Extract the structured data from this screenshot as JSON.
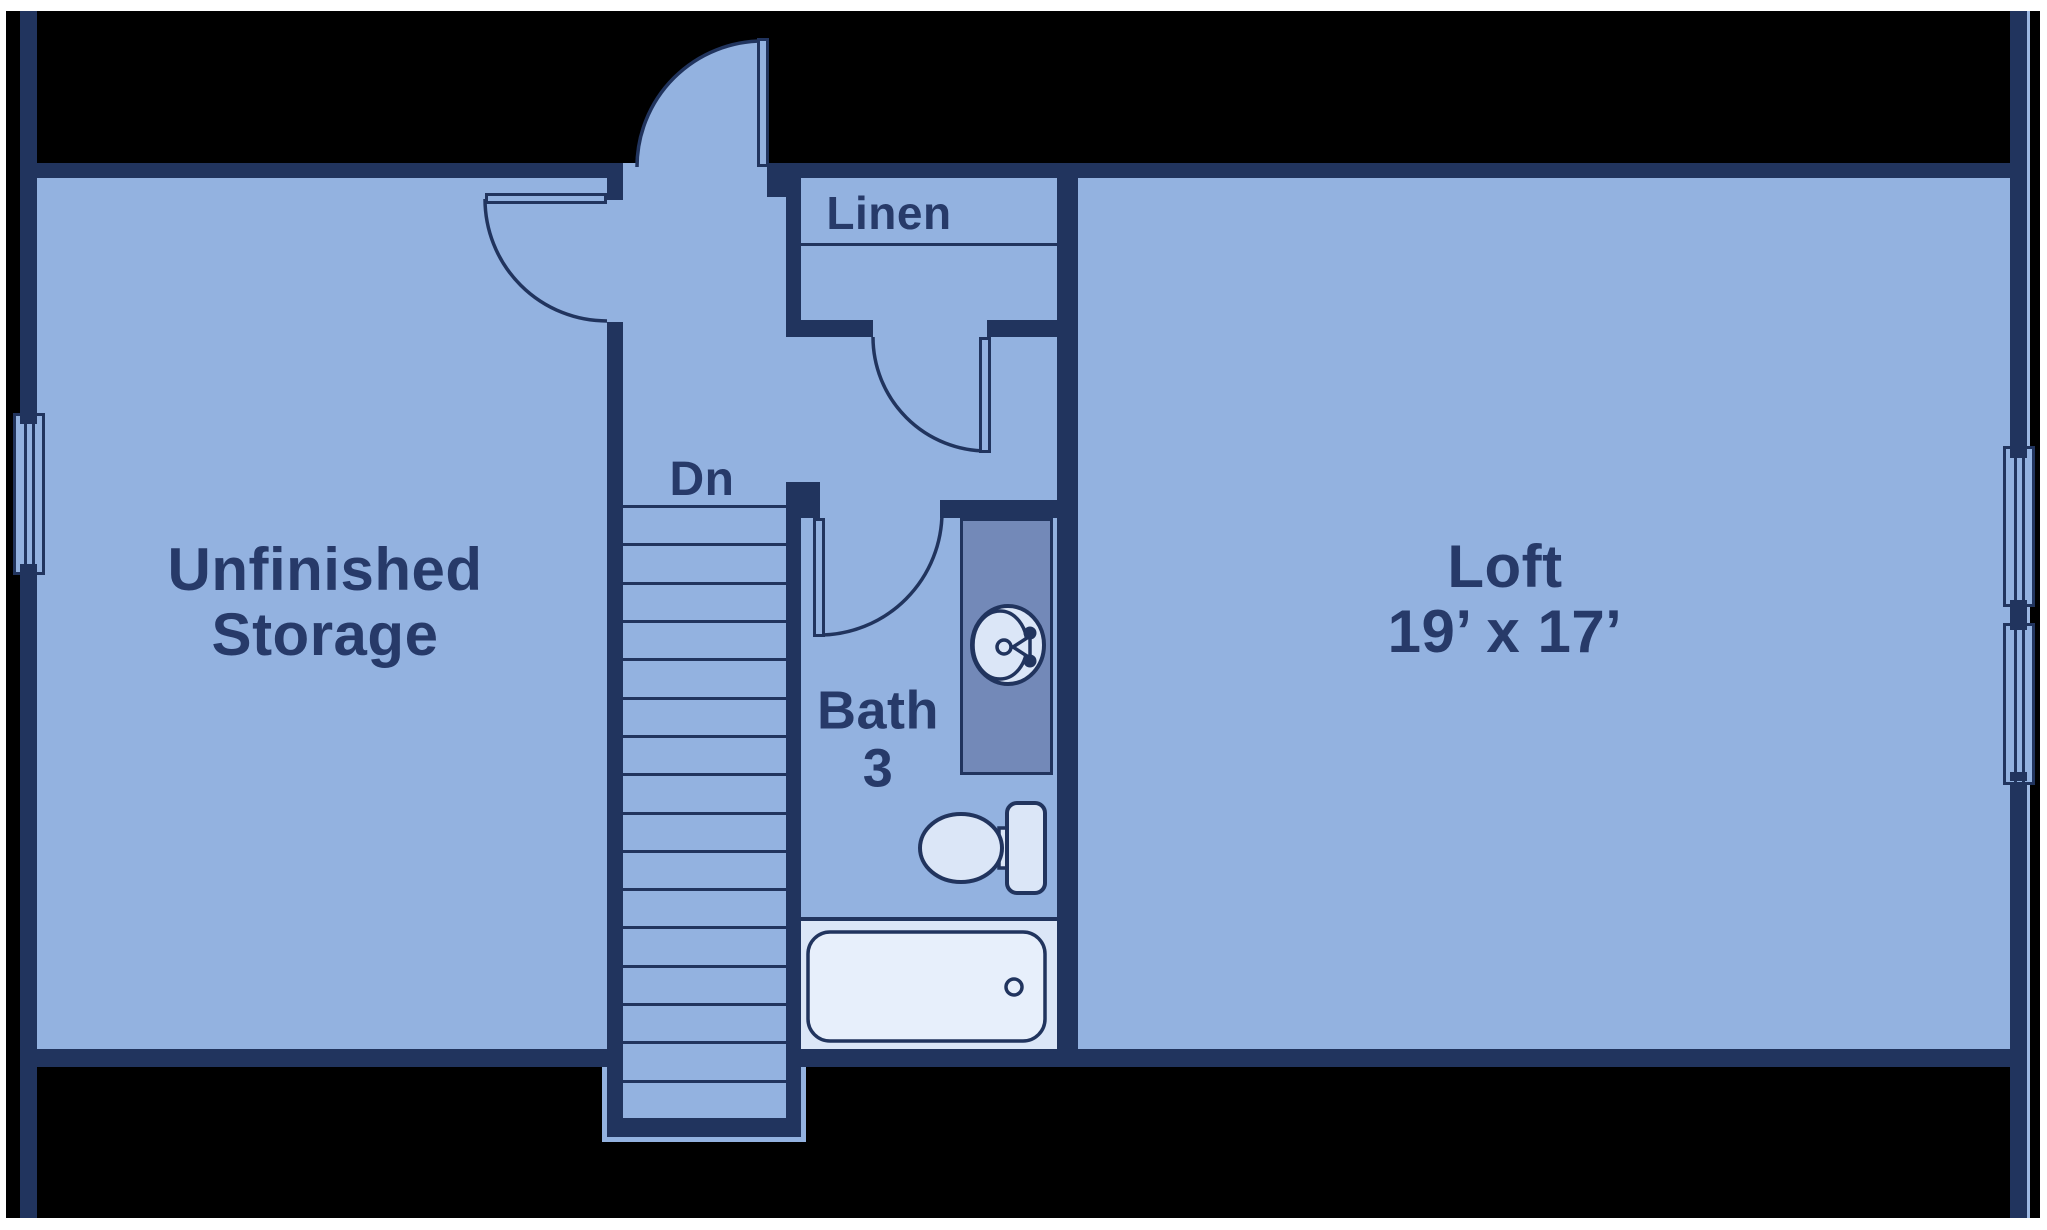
{
  "labels": {
    "storage": {
      "line1": "Unfinished",
      "line2": "Storage"
    },
    "loft": {
      "name": "Loft",
      "dims": "19’ x 17’"
    },
    "bath": {
      "line1": "Bath",
      "line2": "3"
    },
    "linen": "Linen",
    "stairs_direction": "Dn"
  },
  "stairs": {
    "tread_count": 17
  },
  "colors": {
    "page": "#ffffff",
    "canvas": "#000000",
    "wall": "#21345e",
    "floor": "#93b2e0",
    "fixture_light": "#dbe6f7",
    "tub_fill": "#e7effb",
    "vanity": "#7389b8",
    "text": "#273a69",
    "wall_edge_highlight": "#9db8e2"
  }
}
